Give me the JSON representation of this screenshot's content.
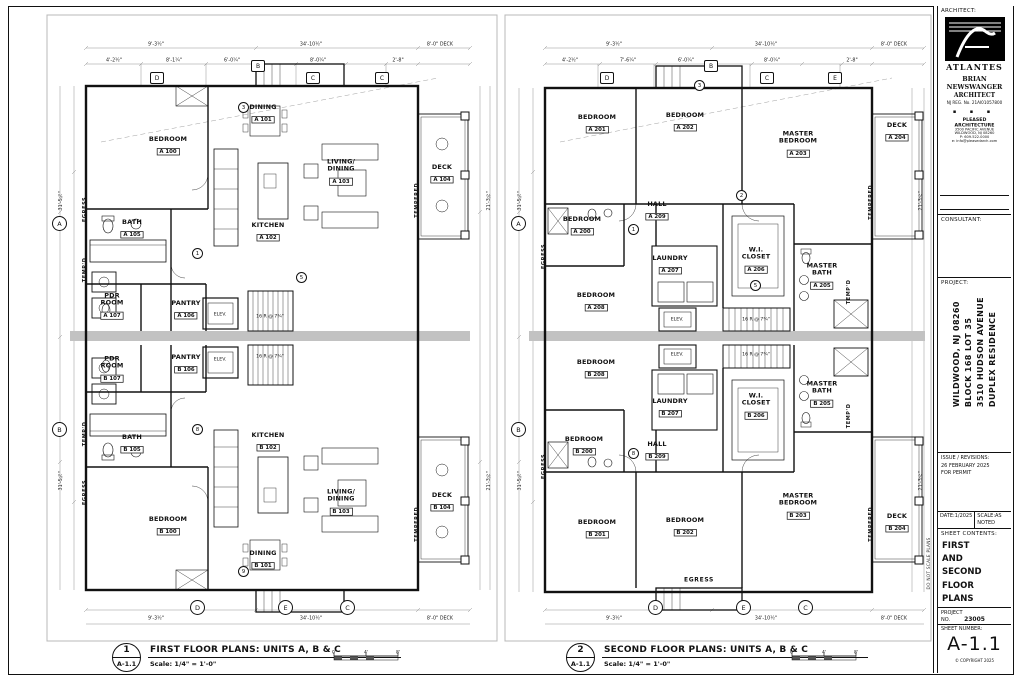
{
  "titleblock": {
    "architect_label": "ARCHITECT:",
    "logo_text": "ATLANTES",
    "name": "BRIAN NEWSWANGER",
    "title": "ARCHITECT",
    "reg": "NJ REG. No. 21AI01057800",
    "dots": "▪ ▪ ▪",
    "firm_name": "PLEASED",
    "firm_name2": "ARCHITECTURE",
    "firm_addr1": "3500 PACIFIC AVENUE",
    "firm_addr2": "WILDWOOD, NJ 08260",
    "firm_phone": "P: 609.522.0000",
    "firm_email": "e: info@pleasedarch.com",
    "consultant_label": "CONSULTANT:",
    "project_label": "PROJECT:",
    "project_line1": "DUPLEX RESIDENCE",
    "project_line2": "3510 HUDSON AVENUE",
    "project_line3": "BLOCK 168 LOT 35",
    "project_line4": "WILDWOOD, NJ 08260",
    "issue_label": "ISSUE / REVISIONS:",
    "issue_line1": "26 FEBRUARY 2025",
    "issue_line2": "FOR PERMIT",
    "date_label": "DATE:",
    "date_value": "1/2025",
    "scale_label": "SCALE:",
    "scale_value": "AS NOTED",
    "contents_label": "SHEET CONTENTS:",
    "contents_1": "FIRST",
    "contents_2": "AND",
    "contents_3": "SECOND",
    "contents_4": "FLOOR",
    "contents_5": "PLANS",
    "projno_label": "PROJECT NO.",
    "projno_value": "23005",
    "sheetno_label": "SHEET NUMBER:",
    "sheetno_value": "A-1.1",
    "copyright": "© COPYRIGHT 2025",
    "side_note": "DO NOT SCALE PLANS"
  },
  "plan1": {
    "tag_num": "1",
    "tag_sheet": "A-1.1",
    "title": "FIRST FLOOR PLANS: UNITS A, B & C",
    "scale_note": "Scale: 1/4\" = 1'-0\"",
    "rooms": [
      {
        "n1": "BEDROOM",
        "n2": "",
        "num": "A 100"
      },
      {
        "n1": "DINING",
        "n2": "",
        "num": "A 101"
      },
      {
        "n1": "KITCHEN",
        "n2": "",
        "num": "A 102"
      },
      {
        "n1": "LIVING/",
        "n2": "DINING",
        "num": "A 103"
      },
      {
        "n1": "DECK",
        "n2": "",
        "num": "A 104"
      },
      {
        "n1": "BATH",
        "n2": "",
        "num": "A 105"
      },
      {
        "n1": "PANTRY",
        "n2": "",
        "num": "A 106"
      },
      {
        "n1": "PDR",
        "n2": "ROOM",
        "num": "A 107"
      },
      {
        "n1": "PANTRY",
        "n2": "",
        "num": "B 106"
      },
      {
        "n1": "PDR",
        "n2": "ROOM",
        "num": "B 107"
      },
      {
        "n1": "BATH",
        "n2": "",
        "num": "B 105"
      },
      {
        "n1": "KITCHEN",
        "n2": "",
        "num": "B 102"
      },
      {
        "n1": "BEDROOM",
        "n2": "",
        "num": "B 100"
      },
      {
        "n1": "DINING",
        "n2": "",
        "num": "B 101"
      },
      {
        "n1": "LIVING/",
        "n2": "DINING",
        "num": "B 103"
      },
      {
        "n1": "DECK",
        "n2": "",
        "num": "B 104"
      }
    ],
    "side_labels": [
      "EGRESS",
      "TEMP'D",
      "TEMP'D",
      "EGRESS",
      "TEMPERED",
      "TEMPERED"
    ],
    "elev_label": "ELEV.",
    "stair_note": "16 R @ 7¾\"",
    "dims": [
      "9'-3½\"",
      "34'-10½\"",
      "8'-0\" DECK",
      "4'-2½\"",
      "8'-1¼\"",
      "6'-0¼\"",
      "8'-0¼\"",
      "2'-8\"",
      "9'-3½\"",
      "34'-10½\"",
      "8'-0\" DECK",
      "31'-5¼\"",
      "31'-5¼\"",
      "21'-3½\"",
      "21'-3½\""
    ],
    "bubbles": [
      "A",
      "B",
      "D",
      "E",
      "C"
    ],
    "hexes": [
      "D",
      "B",
      "C",
      "C"
    ],
    "door_tags": [
      "1",
      "3",
      "5",
      "8",
      "9"
    ]
  },
  "plan2": {
    "tag_num": "2",
    "tag_sheet": "A-1.1",
    "title": "SECOND FLOOR PLANS: UNITS A, B & C",
    "scale_note": "Scale: 1/4\" = 1'-0\"",
    "rooms": [
      {
        "n1": "BEDROOM",
        "n2": "",
        "num": "A 201"
      },
      {
        "n1": "BEDROOM",
        "n2": "",
        "num": "A 202"
      },
      {
        "n1": "MASTER",
        "n2": "BEDROOM",
        "num": "A 203"
      },
      {
        "n1": "DECK",
        "n2": "",
        "num": "A 204"
      },
      {
        "n1": "MASTER",
        "n2": "BATH",
        "num": "A 205"
      },
      {
        "n1": "W.I.",
        "n2": "CLOSET",
        "num": "A 206"
      },
      {
        "n1": "LAUNDRY",
        "n2": "",
        "num": "A 207"
      },
      {
        "n1": "BEDROOM",
        "n2": "",
        "num": "A 208"
      },
      {
        "n1": "HALL",
        "n2": "",
        "num": "A 209"
      },
      {
        "n1": "BEDROOM",
        "n2": "",
        "num": "A 200"
      },
      {
        "n1": "BEDROOM",
        "n2": "",
        "num": "B 200"
      },
      {
        "n1": "HALL",
        "n2": "",
        "num": "B 209"
      },
      {
        "n1": "BEDROOM",
        "n2": "",
        "num": "B 208"
      },
      {
        "n1": "LAUNDRY",
        "n2": "",
        "num": "B 207"
      },
      {
        "n1": "W.I.",
        "n2": "CLOSET",
        "num": "B 206"
      },
      {
        "n1": "MASTER",
        "n2": "BATH",
        "num": "B 205"
      },
      {
        "n1": "BEDROOM",
        "n2": "",
        "num": "B 201"
      },
      {
        "n1": "BEDROOM",
        "n2": "",
        "num": "B 202"
      },
      {
        "n1": "MASTER",
        "n2": "BEDROOM",
        "num": "B 203"
      },
      {
        "n1": "DECK",
        "n2": "",
        "num": "B 204"
      }
    ],
    "side_labels": [
      "EGRESS",
      "EGRESS",
      "TEMP'D",
      "TEMP'D",
      "TEMPERED",
      "TEMPERED"
    ],
    "egress_label": "EGRESS",
    "elev_label": "ELEV.",
    "stair_note": "16 R @ 7¾\"",
    "dims": [
      "9'-3½\"",
      "34'-10½\"",
      "8'-0\" DECK",
      "4'-2½\"",
      "7'-6¼\"",
      "6'-0¼\"",
      "8'-0¼\"",
      "2'-8\"",
      "9'-3½\"",
      "34'-10½\"",
      "8'-0\" DECK",
      "31'-5¼\"",
      "31'-5¼\"",
      "21'-3½\"",
      "21'-3½\""
    ],
    "bubbles": [
      "A",
      "B",
      "D",
      "E",
      "C"
    ],
    "hexes": [
      "D",
      "B",
      "C",
      "E"
    ],
    "door_tags": [
      "1",
      "2",
      "3",
      "5",
      "8"
    ]
  },
  "scalebar": [
    "0'",
    "4'",
    "8'"
  ]
}
